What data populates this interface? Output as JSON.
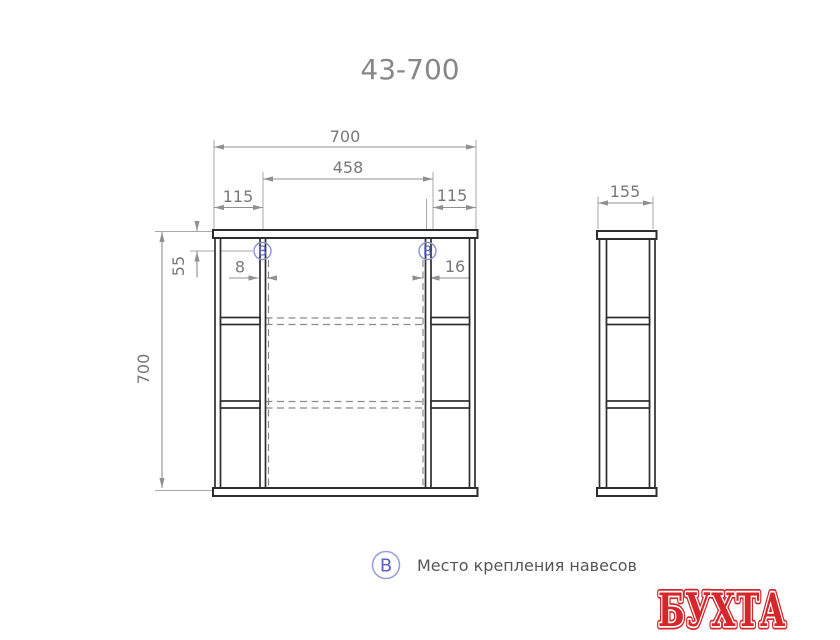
{
  "title": "43-700",
  "front_view": {
    "dim_width_total": "700",
    "dim_hanger_span": "458",
    "dim_left_offset": "115",
    "dim_right_offset": "115",
    "dim_height_total": "700",
    "dim_hanger_from_top": "55",
    "dim_left_hanger_inset": "8",
    "dim_right_hanger_inset": "16",
    "hanger_marker": "B"
  },
  "side_view": {
    "dim_depth": "155"
  },
  "legend": {
    "marker": "B",
    "label": "Место крепления навесов"
  },
  "logo": {
    "text": "БУХТА"
  },
  "colors": {
    "structure_line": "#2e2e2e",
    "dimension_gray": "#787878",
    "marker_blue": "#5a61c8",
    "logo_red": "#d5262b"
  }
}
